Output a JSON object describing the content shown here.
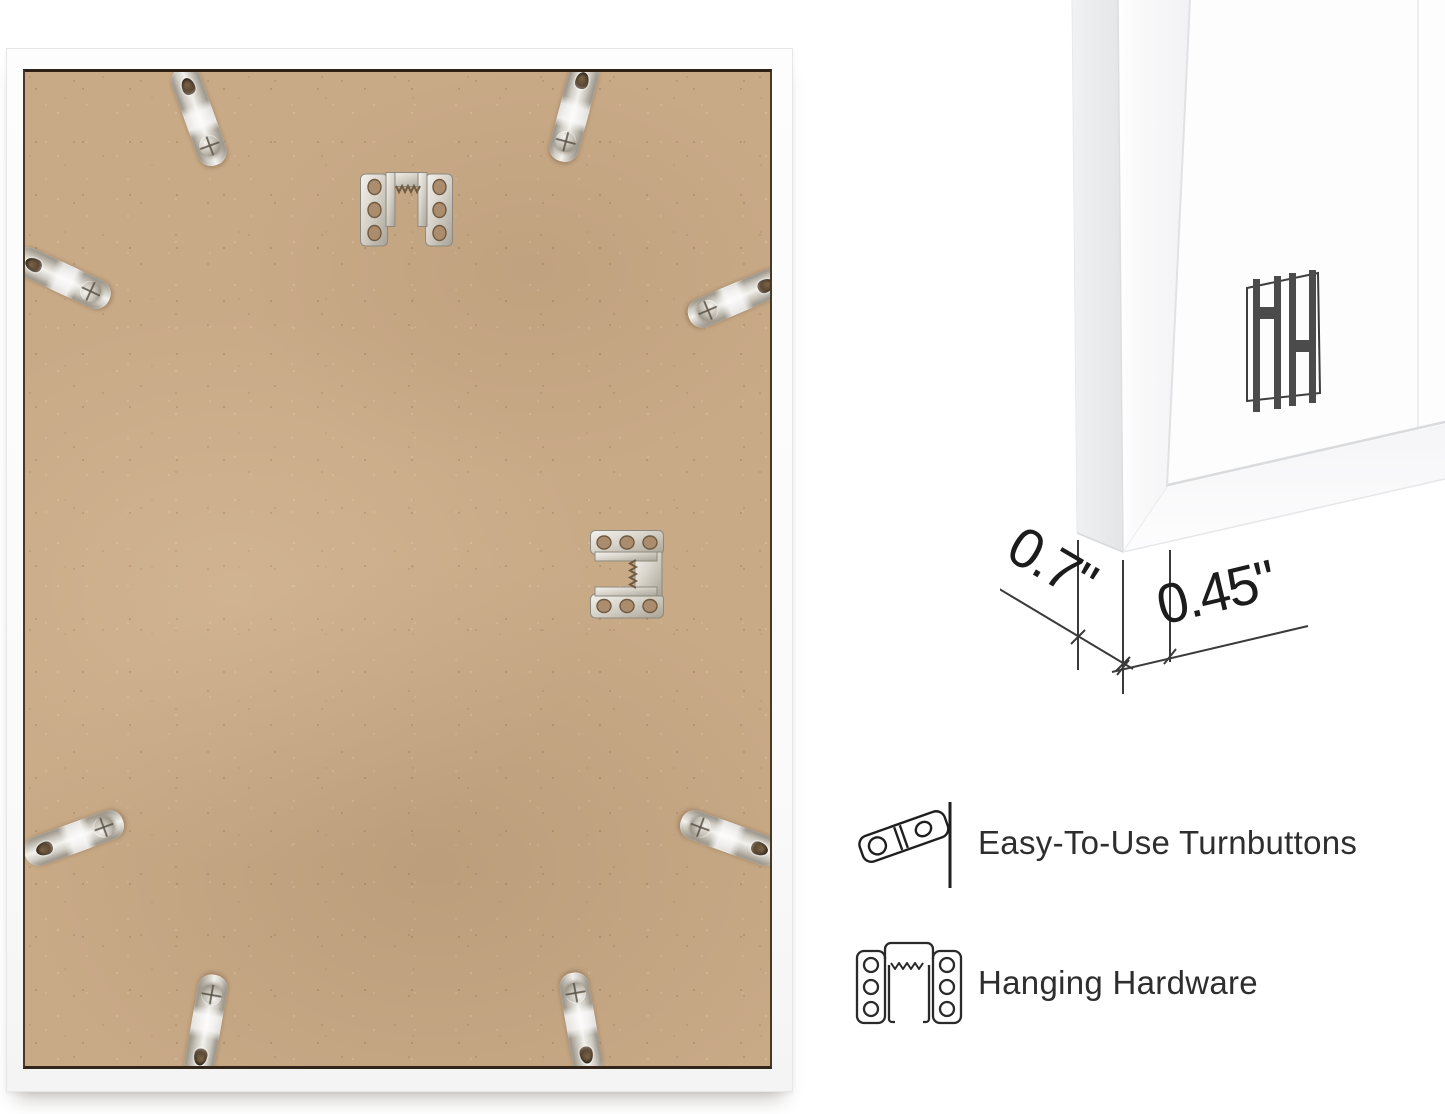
{
  "page": {
    "background_color": "#ffffff"
  },
  "back_view": {
    "mdf_color": "#c9aa87",
    "frame_color": "#fcfcfc",
    "turnbutton_count": 8,
    "sawtooth_hanger_count": 2
  },
  "corner_view": {
    "logo_monogram": "HH",
    "depth_label": "0.7\"",
    "face_width_label": "0.45\""
  },
  "features": [
    {
      "icon": "turnbutton-icon",
      "label": "Easy-To-Use Turnbuttons"
    },
    {
      "icon": "hanging-hardware-icon",
      "label": "Hanging Hardware"
    }
  ],
  "annotation": {
    "line_color": "#3a3a3a",
    "text_color": "#1c1c1c",
    "logo_color": "#4a4a4a"
  }
}
